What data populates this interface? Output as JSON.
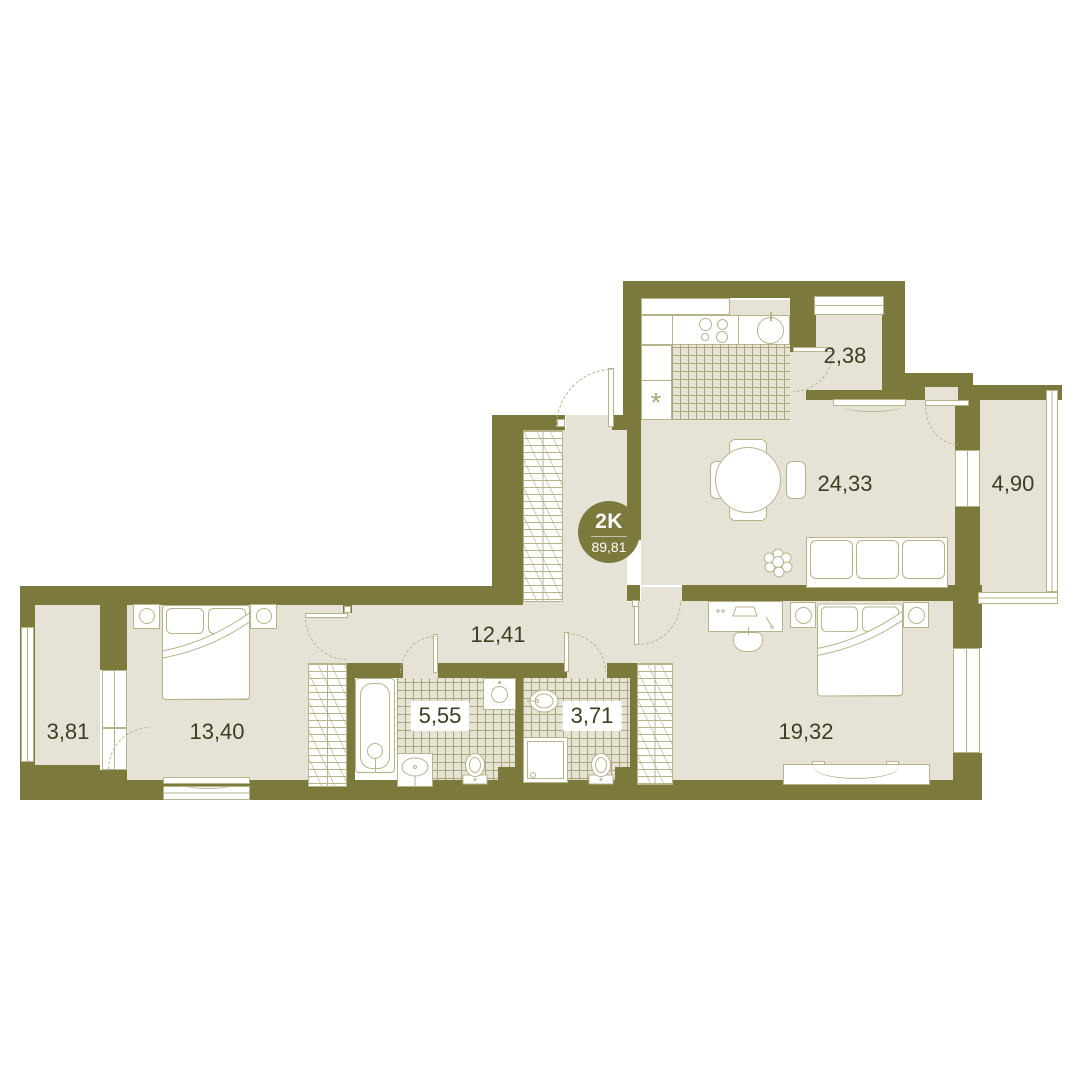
{
  "plan": {
    "badge": {
      "type": "2K",
      "area": "89,81"
    },
    "rooms": [
      {
        "id": "balcony-top",
        "label": "2,38"
      },
      {
        "id": "kitchen-living",
        "label": "24,33"
      },
      {
        "id": "balcony-right",
        "label": "4,90"
      },
      {
        "id": "hallway",
        "label": "12,41"
      },
      {
        "id": "balcony-left",
        "label": "3,81"
      },
      {
        "id": "bedroom-left",
        "label": "13,40"
      },
      {
        "id": "bathroom-large",
        "label": "5,55"
      },
      {
        "id": "bathroom-small",
        "label": "3,71"
      },
      {
        "id": "bedroom-right",
        "label": "19,32"
      }
    ],
    "fridge_symbol": "*",
    "colors": {
      "wall": "#7b793c",
      "floor": "#e6e3d6",
      "furniture_outline": "#b7b48c",
      "tile_line": "#a9a67a",
      "label_text": "#3e3d20",
      "background": "#ffffff",
      "badge_text": "#ffffff"
    }
  }
}
